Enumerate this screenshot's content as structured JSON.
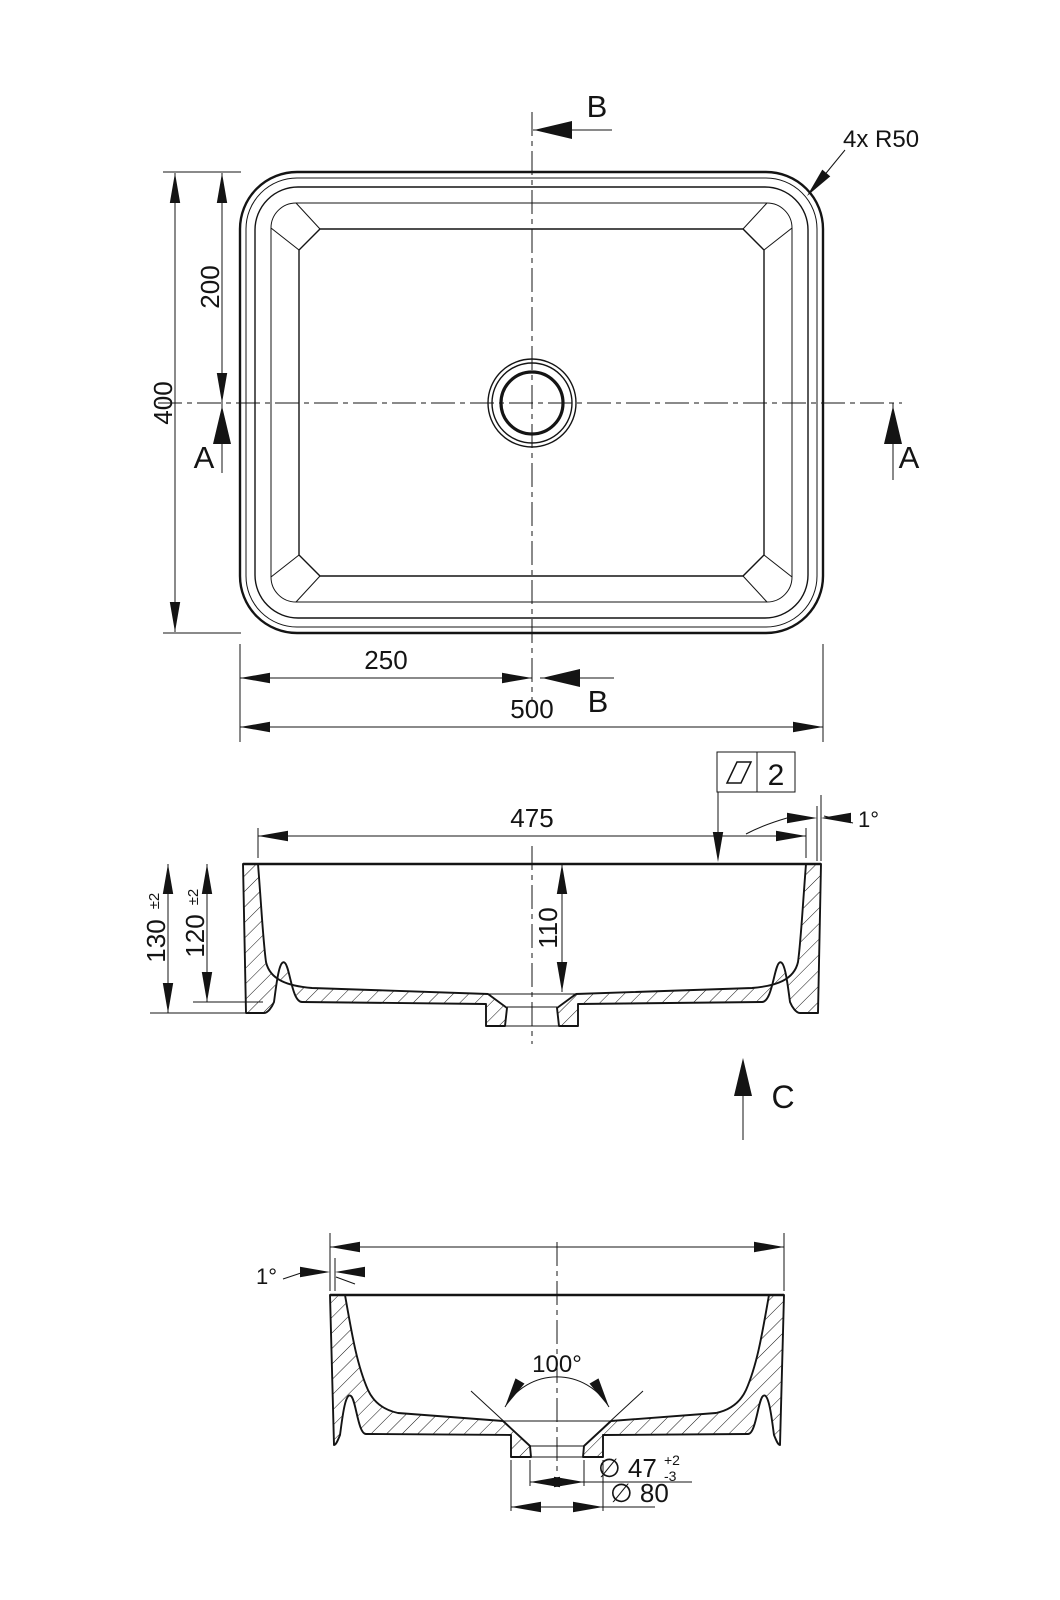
{
  "top_view": {
    "width": "500",
    "height": "400",
    "half_width": "250",
    "half_height": "200",
    "corner_note": "4x R50",
    "section_a": "A",
    "section_b": "B"
  },
  "front_section": {
    "inner_width": "475",
    "total_height": "130",
    "total_height_tol": "±2",
    "inner_height": "120",
    "inner_height_tol": "±2",
    "bowl_depth": "110",
    "draft_angle": "1°",
    "flatness_value": "2",
    "view_label": "C"
  },
  "side_section": {
    "draft_angle": "1°",
    "drain_cone_angle": "100°",
    "drain_dia": "∅ 47",
    "drain_tol_plus": "+2",
    "drain_tol_minus": "-3",
    "boss_dia": "∅ 80"
  }
}
